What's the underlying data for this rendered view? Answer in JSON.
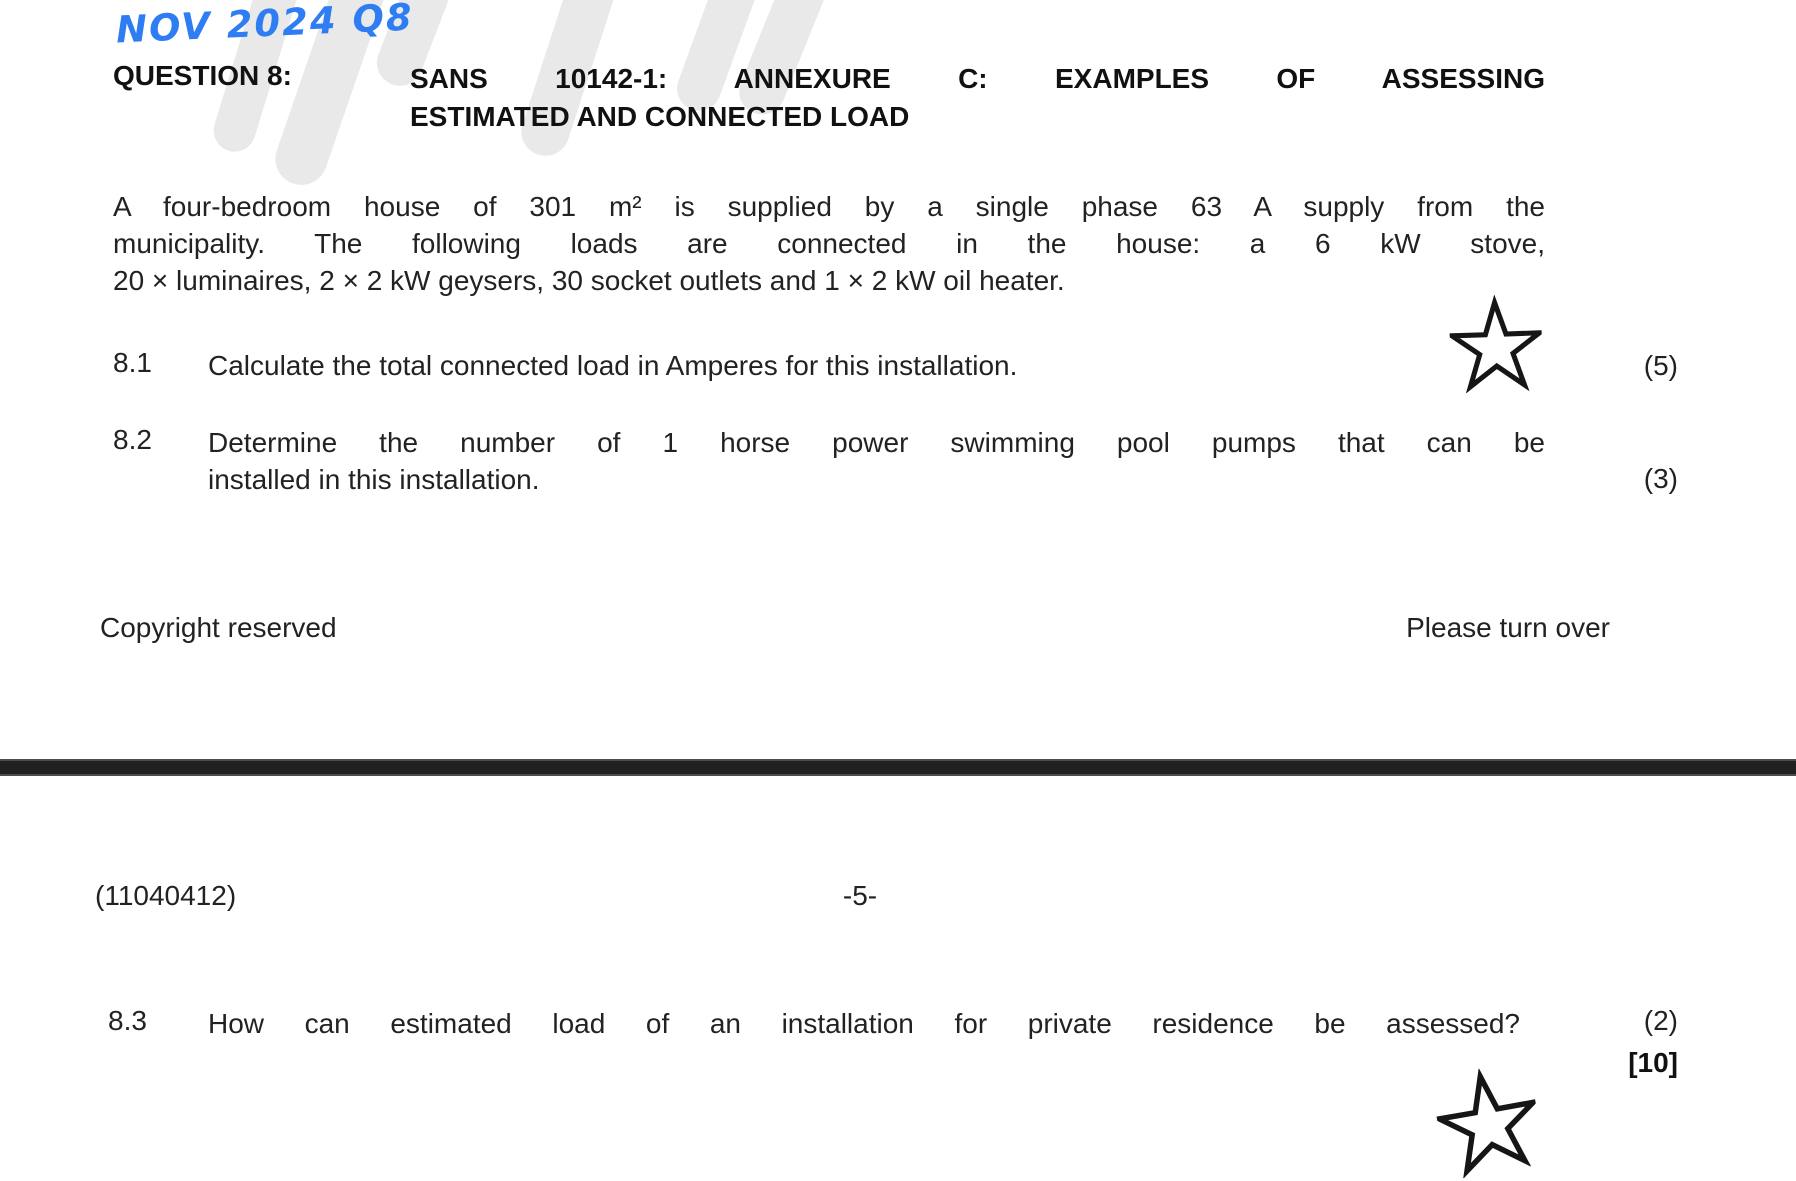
{
  "page": {
    "annotation": "NOV 2024 Q8",
    "colors": {
      "annotation_blue": "#2f7df2",
      "body_text": "#222222",
      "heading_text": "#111111",
      "divider_bar": "#212121",
      "watermark_gray": "#e9e9e9"
    }
  },
  "question_header": {
    "label": "QUESTION 8:",
    "title_line1": "SANS 10142-1: ANNEXURE C: EXAMPLES OF ASSESSING",
    "title_line2": "ESTIMATED AND CONNECTED LOAD"
  },
  "intro": {
    "line1": "A four-bedroom house of 301 m² is supplied by a single phase 63 A supply from the",
    "line2": "municipality. The following loads are connected in the house: a 6 kW stove,",
    "line3": "20 × luminaires, 2 × 2 kW geysers, 30 socket outlets and 1 × 2 kW oil heater."
  },
  "questions": [
    {
      "number": "8.1",
      "line1": "Calculate the total connected load in Amperes for this installation.",
      "marks": "(5)"
    },
    {
      "number": "8.2",
      "line1": "Determine the number of 1 horse power swimming pool pumps that can be",
      "line2": "installed in this installation.",
      "marks": "(3)"
    },
    {
      "number": "8.3",
      "line1": "How can estimated load of an installation for private residence be assessed?",
      "marks": "(2)"
    }
  ],
  "total_marks": "[10]",
  "footer_page4": {
    "left": "Copyright reserved",
    "right": "Please turn over"
  },
  "page5_header": {
    "exam_code": "(11040412)",
    "page_number": "-5-"
  }
}
